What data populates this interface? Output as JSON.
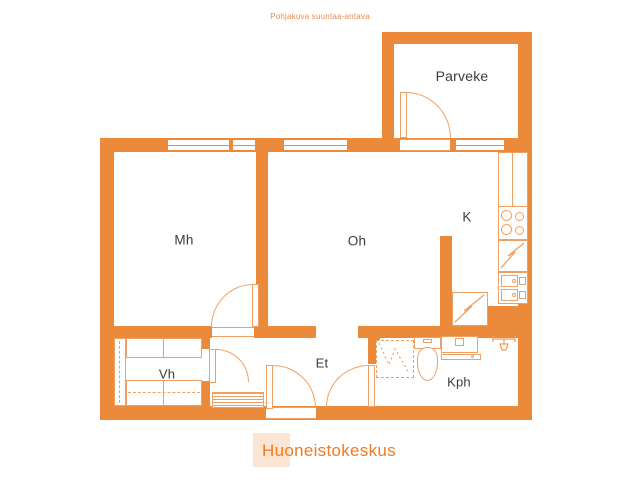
{
  "caption": "Pohjakuva suuntaa-antava",
  "rooms": [
    {
      "label": "Parveke"
    },
    {
      "label": "Mh"
    },
    {
      "label": "Oh"
    },
    {
      "label": "K"
    },
    {
      "label": "Vh"
    },
    {
      "label": "Et"
    },
    {
      "label": "Kph"
    }
  ],
  "logo": {
    "text": "Huoneistokeskus"
  },
  "symbols": {
    "kitchen": [
      "stove-icon",
      "refrigerator-icon",
      "kitchen-sink-icon",
      "appliance-icon"
    ],
    "bathroom": [
      "shower-icon",
      "toilet-icon",
      "bathroom-sink-icon",
      "washer-tap-icon"
    ],
    "hall": [
      "wardrobe-icon",
      "cabinet-icon",
      "doormat-icon"
    ],
    "doors": [
      "door-arc",
      "window-symbol"
    ]
  },
  "colors": {
    "wall": "#EB8A3A",
    "fixture_line": "#F0A062",
    "label_text": "#3B3B3B",
    "caption_text": "#F08A50",
    "logo_text": "#F4791F",
    "logo_background": "#FBE5D3"
  }
}
